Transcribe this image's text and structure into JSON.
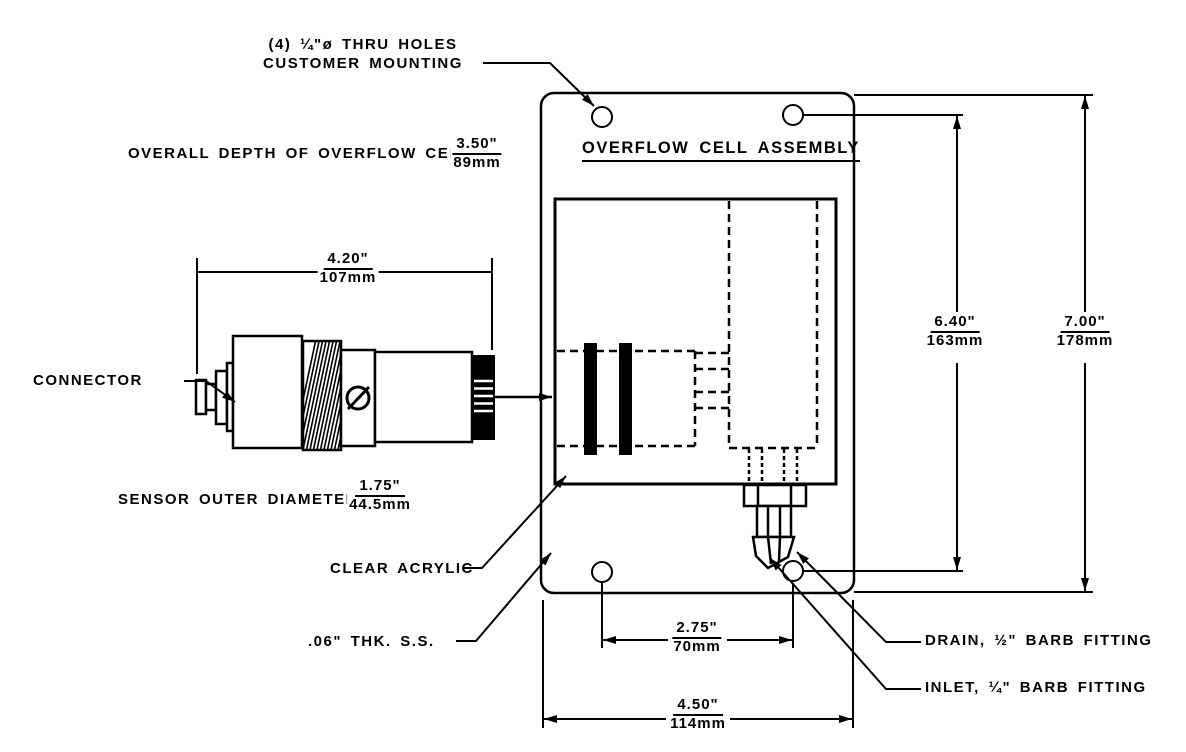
{
  "drawing": {
    "title": "OVERFLOW CELL ASSEMBLY",
    "callouts": {
      "thru_holes_line1": "(4) ¼\"ø THRU HOLES",
      "thru_holes_line2": "CUSTOMER MOUNTING",
      "overall_depth_label": "OVERALL DEPTH OF OVERFLOW CELL",
      "connector": "CONNECTOR",
      "sensor_od_label": "SENSOR OUTER DIAMETER",
      "clear_acrylic": "CLEAR ACRYLIC",
      "thk_ss": ".06\" THK. S.S.",
      "drain": "DRAIN, ½\" BARB FITTING",
      "inlet": "INLET, ¼\" BARB FITTING"
    },
    "dimensions": {
      "overall_depth": {
        "inches": "3.50\"",
        "mm": "89mm"
      },
      "sensor_length": {
        "inches": "4.20\"",
        "mm": "107mm"
      },
      "sensor_od": {
        "inches": "1.75\"",
        "mm": "44.5mm"
      },
      "hole_span_height": {
        "inches": "6.40\"",
        "mm": "163mm"
      },
      "plate_height": {
        "inches": "7.00\"",
        "mm": "178mm"
      },
      "hole_span_width": {
        "inches": "2.75\"",
        "mm": "70mm"
      },
      "plate_width": {
        "inches": "4.50\"",
        "mm": "114mm"
      }
    },
    "colors": {
      "line": "#000000",
      "background": "#ffffff"
    }
  }
}
